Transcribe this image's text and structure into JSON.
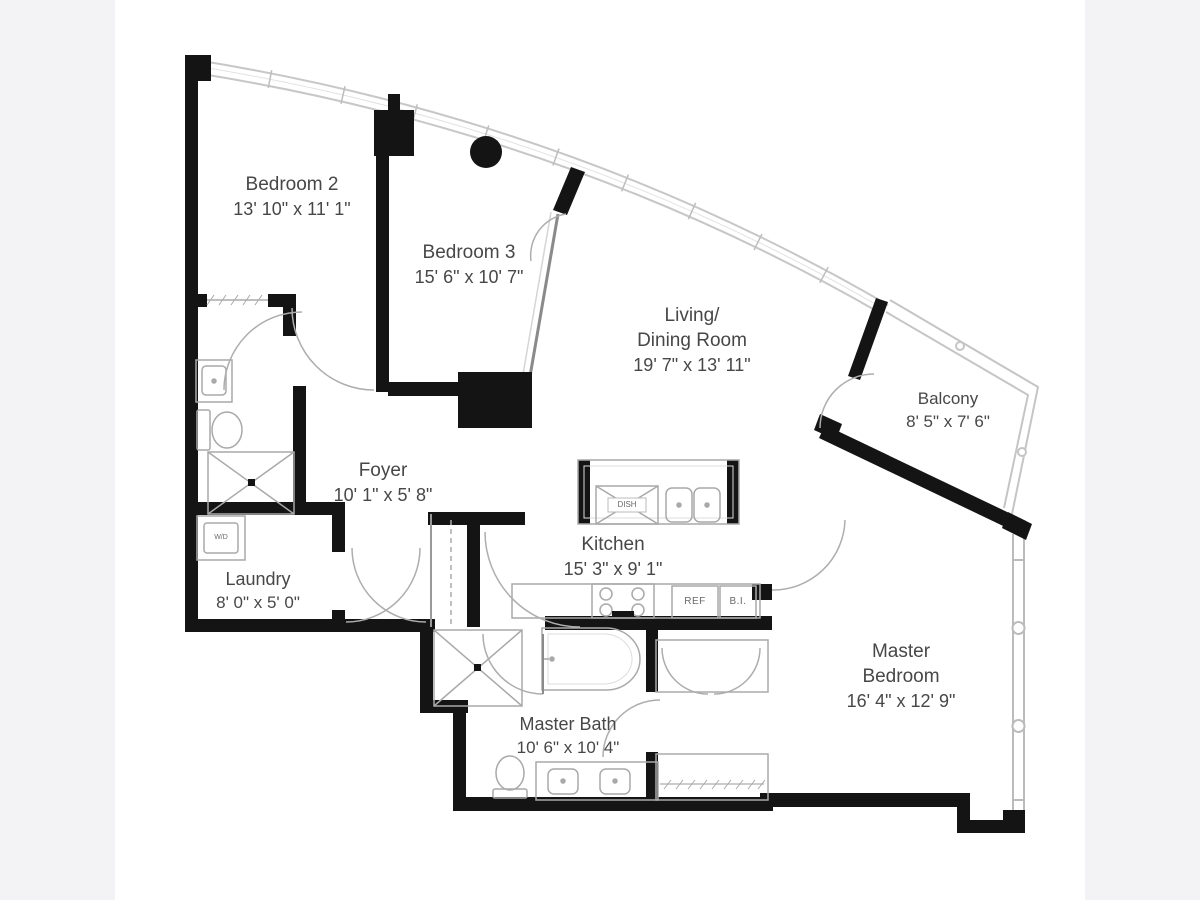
{
  "colors": {
    "background": "#f3f3f5",
    "paper": "#ffffff",
    "wall": "#141414",
    "thin_line": "#b9b9b9",
    "text": "#474747"
  },
  "floorplan": {
    "rooms": [
      {
        "id": "bedroom-2",
        "lines": [
          "Bedroom 2",
          "13' 10\" x 11' 1\""
        ]
      },
      {
        "id": "bedroom-3",
        "lines": [
          "Bedroom 3",
          "15' 6\" x 10' 7\""
        ]
      },
      {
        "id": "living-dining",
        "lines": [
          "Living/",
          "Dining Room",
          "19' 7\" x 13' 11\""
        ]
      },
      {
        "id": "balcony",
        "lines": [
          "Balcony",
          "8' 5\" x 7' 6\""
        ]
      },
      {
        "id": "foyer",
        "lines": [
          "Foyer",
          "10' 1\" x 5' 8\""
        ]
      },
      {
        "id": "kitchen",
        "lines": [
          "Kitchen",
          "15' 3\" x 9' 1\""
        ]
      },
      {
        "id": "laundry",
        "lines": [
          "Laundry",
          "8' 0\" x 5' 0\""
        ]
      },
      {
        "id": "master-bath",
        "lines": [
          "Master Bath",
          "10' 6\" x 10' 4\""
        ]
      },
      {
        "id": "master-bedroom",
        "lines": [
          "Master",
          "Bedroom",
          "16' 4\" x 12' 9\""
        ]
      }
    ],
    "appliances": {
      "dishwasher": "DISH",
      "refrigerator": "REF",
      "built_in": "B.I.",
      "washer_dryer": "W/D"
    }
  }
}
